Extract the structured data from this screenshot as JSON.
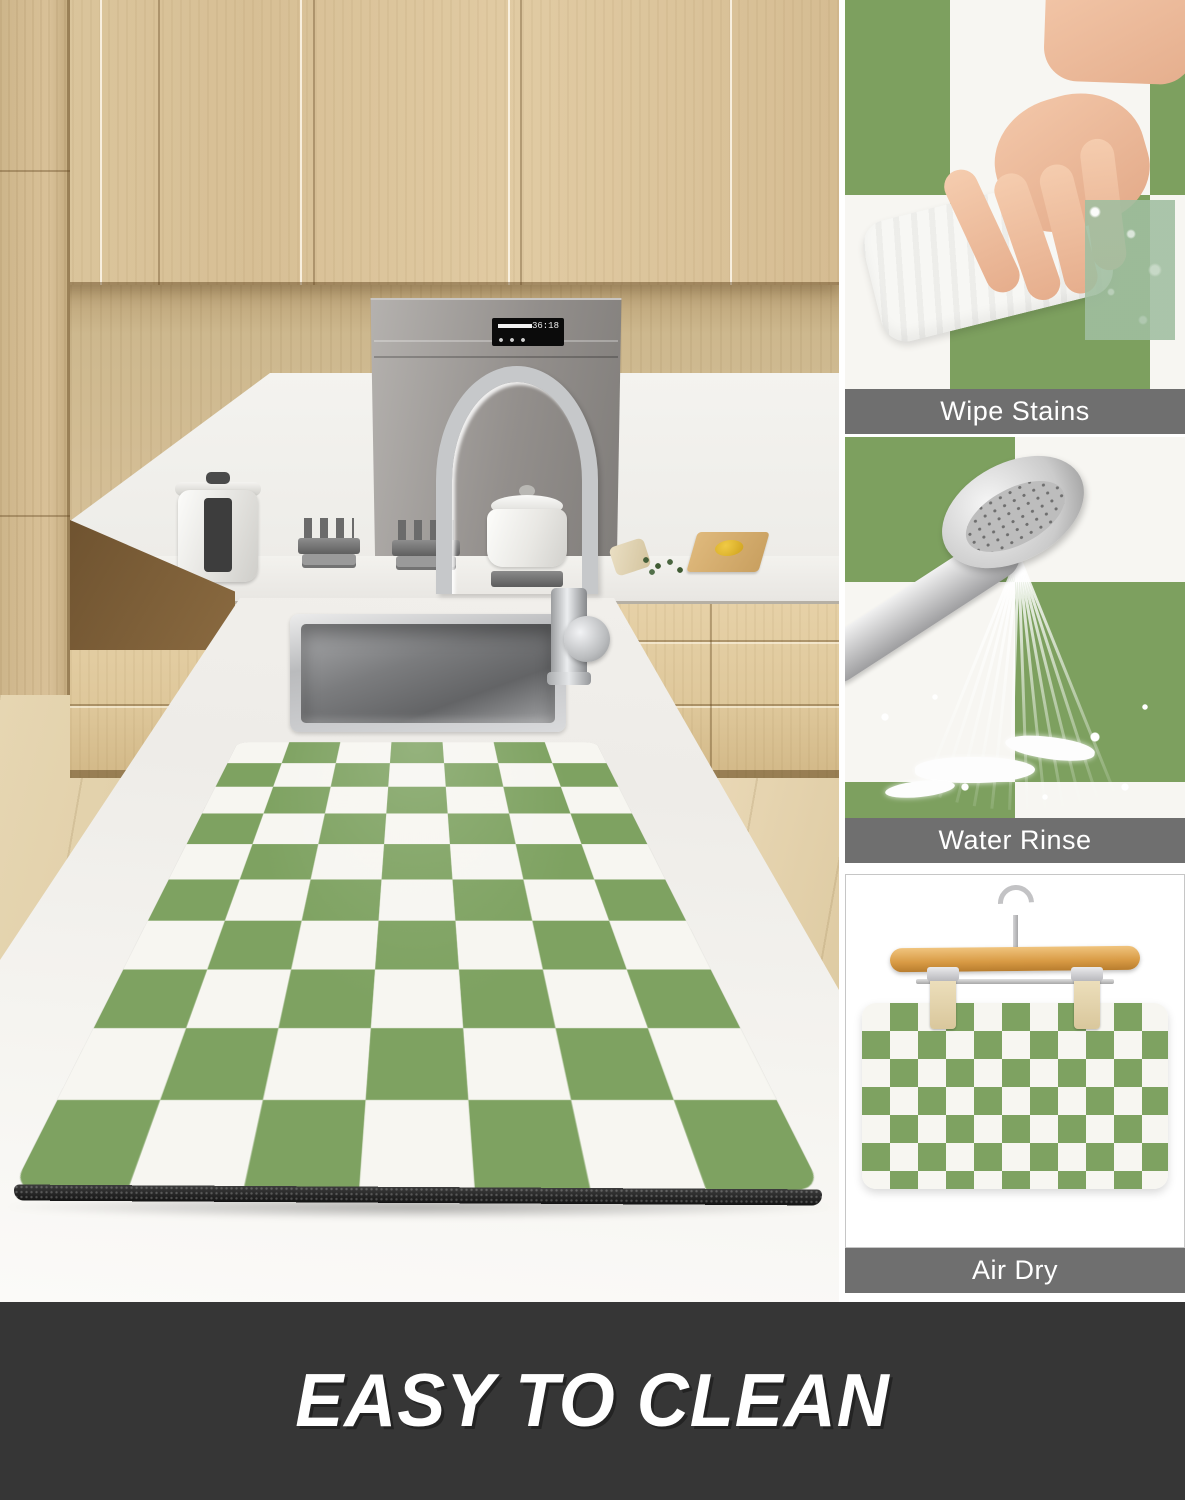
{
  "meta": {
    "kind": "product-marketing-image",
    "product": "green and white checkerboard dish drying mat"
  },
  "banner": {
    "title": "EASY TO CLEAN"
  },
  "sidebar": {
    "panels": [
      {
        "label": "Wipe Stains",
        "illustration": "hand-wiping-mat-with-cloth"
      },
      {
        "label": "Water Rinse",
        "illustration": "shower-head-rinsing-mat"
      },
      {
        "label": "Air Dry",
        "illustration": "mat-hanging-on-wooden-hanger"
      }
    ]
  },
  "main_scene": {
    "description": "kitchen island with stainless sink, gooseneck faucet and checkered drying mat",
    "hood_display": "36:18"
  },
  "colors": {
    "mat_green": "#7ea261",
    "mat_white": "#f7f6f1",
    "mat_base_black": "#1f1f1f",
    "label_bar_bg": "#6f6f6f",
    "banner_bg": "#363636",
    "banner_text": "#ffffff",
    "cabinet_wood": "#dcc79e"
  }
}
